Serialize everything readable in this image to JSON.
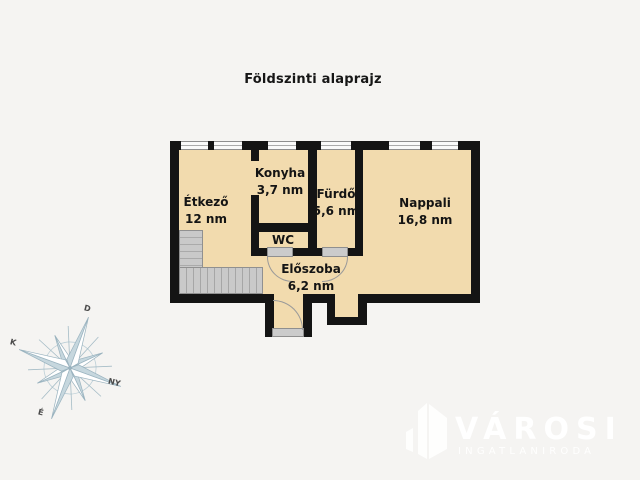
{
  "title": "Földszinti alaprajz",
  "rooms": [
    {
      "name": "Étkező",
      "area": "12 nm"
    },
    {
      "name": "Konyha",
      "area": "3,7 nm"
    },
    {
      "name": "Fürdő",
      "area": "5,6 nm"
    },
    {
      "name": "Nappali",
      "area": "16,8 nm"
    },
    {
      "name": "WC",
      "area": ""
    },
    {
      "name": "Előszoba",
      "area": "6,2 nm"
    }
  ],
  "compass": {
    "north": "É",
    "south": "D",
    "east": "K",
    "west": "NY"
  },
  "logo": {
    "brand": "VÁROSI",
    "tagline": "INGATLANIRODA"
  },
  "colors": {
    "background": "#F5F4F2",
    "floor": "#F2DBAE",
    "wall": "#141414",
    "stairs": "#C6C6C6",
    "window_fill": "#FAFAFA",
    "compass": "#9AB3BF",
    "logo": "#FFFFFF",
    "text": "#141414"
  }
}
